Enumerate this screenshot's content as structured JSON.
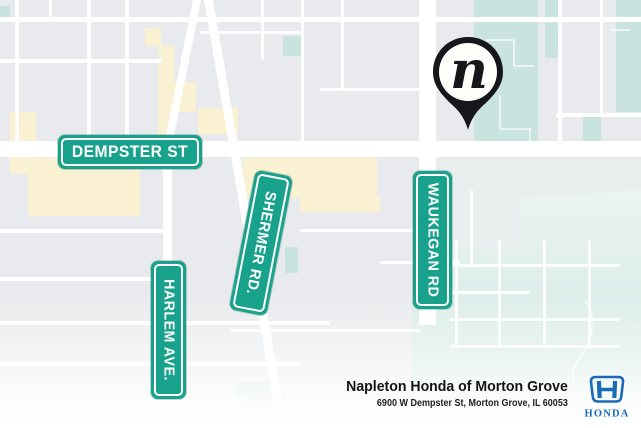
{
  "map": {
    "street_signs": [
      {
        "id": "dempster-st",
        "label": "DEMPSTER ST"
      },
      {
        "id": "shermer-rd",
        "label": "SHERMER RD."
      },
      {
        "id": "harlem-ave",
        "label": "HARLEM AVE."
      },
      {
        "id": "waukegan-rd",
        "label": "WAUKEGAN RD"
      }
    ],
    "pin": {
      "symbol": "n"
    },
    "colors": {
      "sign_teal": "#18a28c",
      "park_teal": "#c9e4df",
      "road_white": "#ffffff",
      "block_gray": "#e8eaed",
      "highlight_yellow": "#faf1d3",
      "pin_black": "#17171b",
      "honda_blue": "#1a6ab8"
    }
  },
  "footer": {
    "dealer_name": "Napleton Honda of Morton Grove",
    "dealer_address": "6900 W Dempster St, Morton Grove, IL 60053",
    "brand_wordmark": "HONDA"
  }
}
